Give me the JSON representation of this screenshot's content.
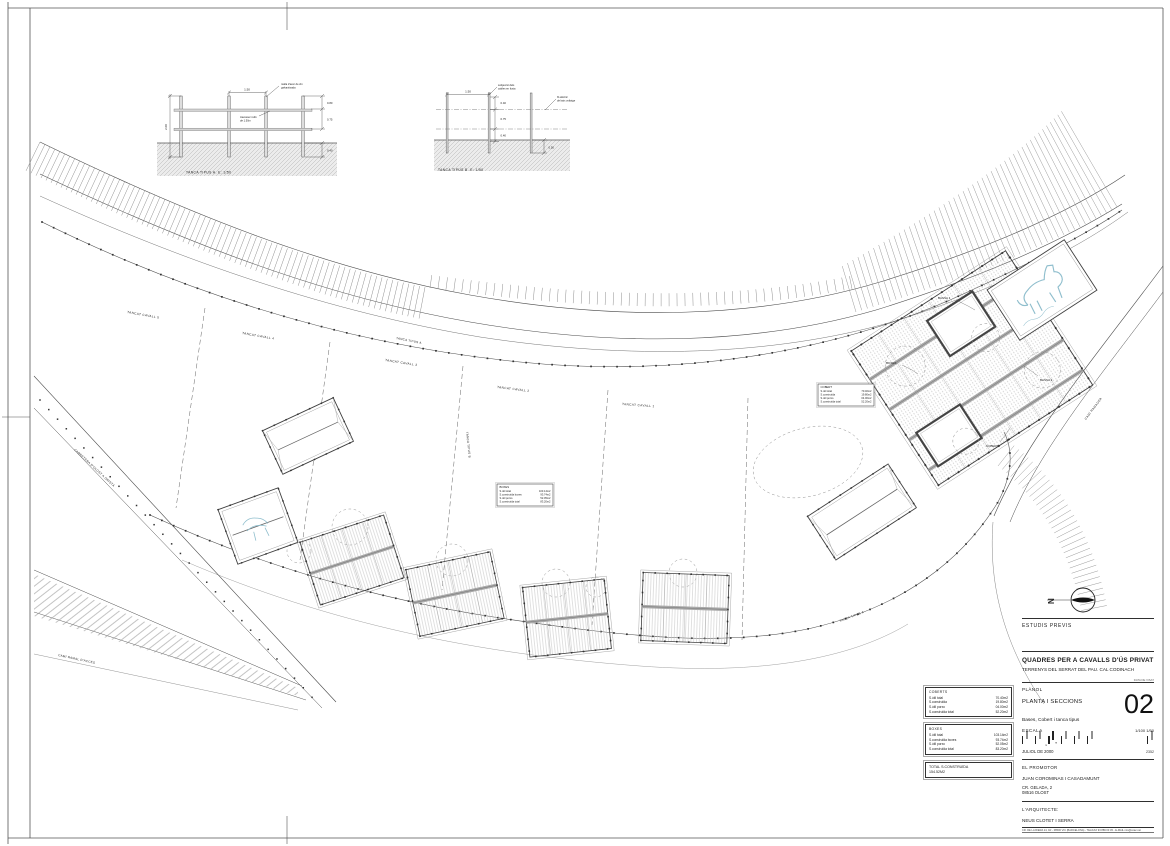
{
  "colors": {
    "paper": "#ffffff",
    "ink": "#2f2f2f",
    "light_line": "#8f8f8f",
    "roof_gray": "#a9a9a9",
    "water_blue": "#8fbecd"
  },
  "title_block": {
    "phase": "ESTUDIS PREVIS",
    "project_title": "QUADRES PER A CAVALLS D'ÚS PRIVAT",
    "project_location": "TERRENYS DEL SERRAT DEL PAU. CAL CODINACH",
    "stamp_note": "DATA DE VISAT",
    "planol_label": "PLÀNOL",
    "sheet_title": "PLANTA I SECCIONS",
    "sheet_number": "02",
    "sheet_content": "Bases, Cobert i tanca tipus",
    "scale_label": "ESCALA",
    "scale_values": "1/100  1/50",
    "scale_unit": "m",
    "date": "JULIOL DE 2000",
    "expedient": "2352",
    "promoter_label": "EL PROMOTOR",
    "promoter_name": "JUAN COROMINAS I CASADAMUNT",
    "promoter_address_1": "CR. GELADA, 2",
    "promoter_address_2": "08516 OLOST",
    "architect_label": "L'ARQUITECTE:",
    "architect_name": "NEUS CLOTET I SERRA",
    "architect_contact": "CR. DE LA RIERA 14, 1R - 08500 VIC (BARCELONA) - TEL/FAX 93 889 03 45 - E-MAIL ncs@coac.net"
  },
  "north": {
    "label": "N"
  },
  "details": {
    "fence_a": {
      "caption": "TANCA TIPUS A. E: 1/50",
      "note_mesh_1": "malla d'acer de 2m",
      "note_mesh_2": "galvanitzada",
      "note_rail_1": "travesser rodó",
      "note_rail_2": "de 1.50m",
      "dim_span": "1.50",
      "dim_height": "2.00",
      "dim_top": "0.80",
      "dim_mid": "0.75",
      "dim_depth": "0.40"
    },
    "fence_b": {
      "caption": "TANCA TIPUS B. E: 1/50",
      "note_fix_1": "subjecció dels",
      "note_fix_2": "cables en fusta",
      "note_wire_1": "fil elèctric",
      "note_wire_2": "de baix voltatge",
      "dim_span": "1.50",
      "dim_top": "0.40",
      "dim_mid": "0.75",
      "dim_low": "0.40",
      "dim_depth": "0.50"
    }
  },
  "plan": {
    "plot_labels": [
      "TANCAT CAVALL 5",
      "TANCAT CAVALL 4",
      "TANCAT CAVALL 3",
      "TANCAT CAVALL 2",
      "TANCAT CAVALL 1"
    ],
    "fence_label_top": "TANCA TIPUS A",
    "fence_label_bottom": "TANCA TIPUS A",
    "fence_b_label": "TANCA TIPUS B",
    "road_upper_left": "CARRETERA D'OLOST A ORISTÀ",
    "road_lower_left": "CAMÍ RAMAL D'ACCÉS",
    "road_right": "CAMÍ RAMADER",
    "cluster_labels": [
      "BASSA 1",
      "BOXES",
      "BASSA 2",
      "COBERT"
    ],
    "legend_titles": [
      "BOXES",
      "COBERT"
    ]
  },
  "summary": {
    "coberts": {
      "title": "COBERTS",
      "rows": [
        {
          "label": "S.útil total",
          "value": "70.40m2"
        },
        {
          "label": "S.construïda",
          "value": "19.80m2"
        },
        {
          "label": "S.útil porxo",
          "value": "04.00m2"
        },
        {
          "label": "S.construïda total",
          "value": "52.20m2"
        }
      ]
    },
    "boxes": {
      "title": "BOXES",
      "rows": [
        {
          "label": "S.útil total",
          "value": "103.14m2"
        },
        {
          "label": "S.construïda boxes",
          "value": "93.74m2"
        },
        {
          "label": "S.útil porxo",
          "value": "52.05m2"
        },
        {
          "label": "S.construïda total",
          "value": "83.20m2"
        }
      ]
    },
    "total": {
      "label": "TOTAL S.CONSTRUÏDA",
      "value": "154.52M2"
    }
  }
}
